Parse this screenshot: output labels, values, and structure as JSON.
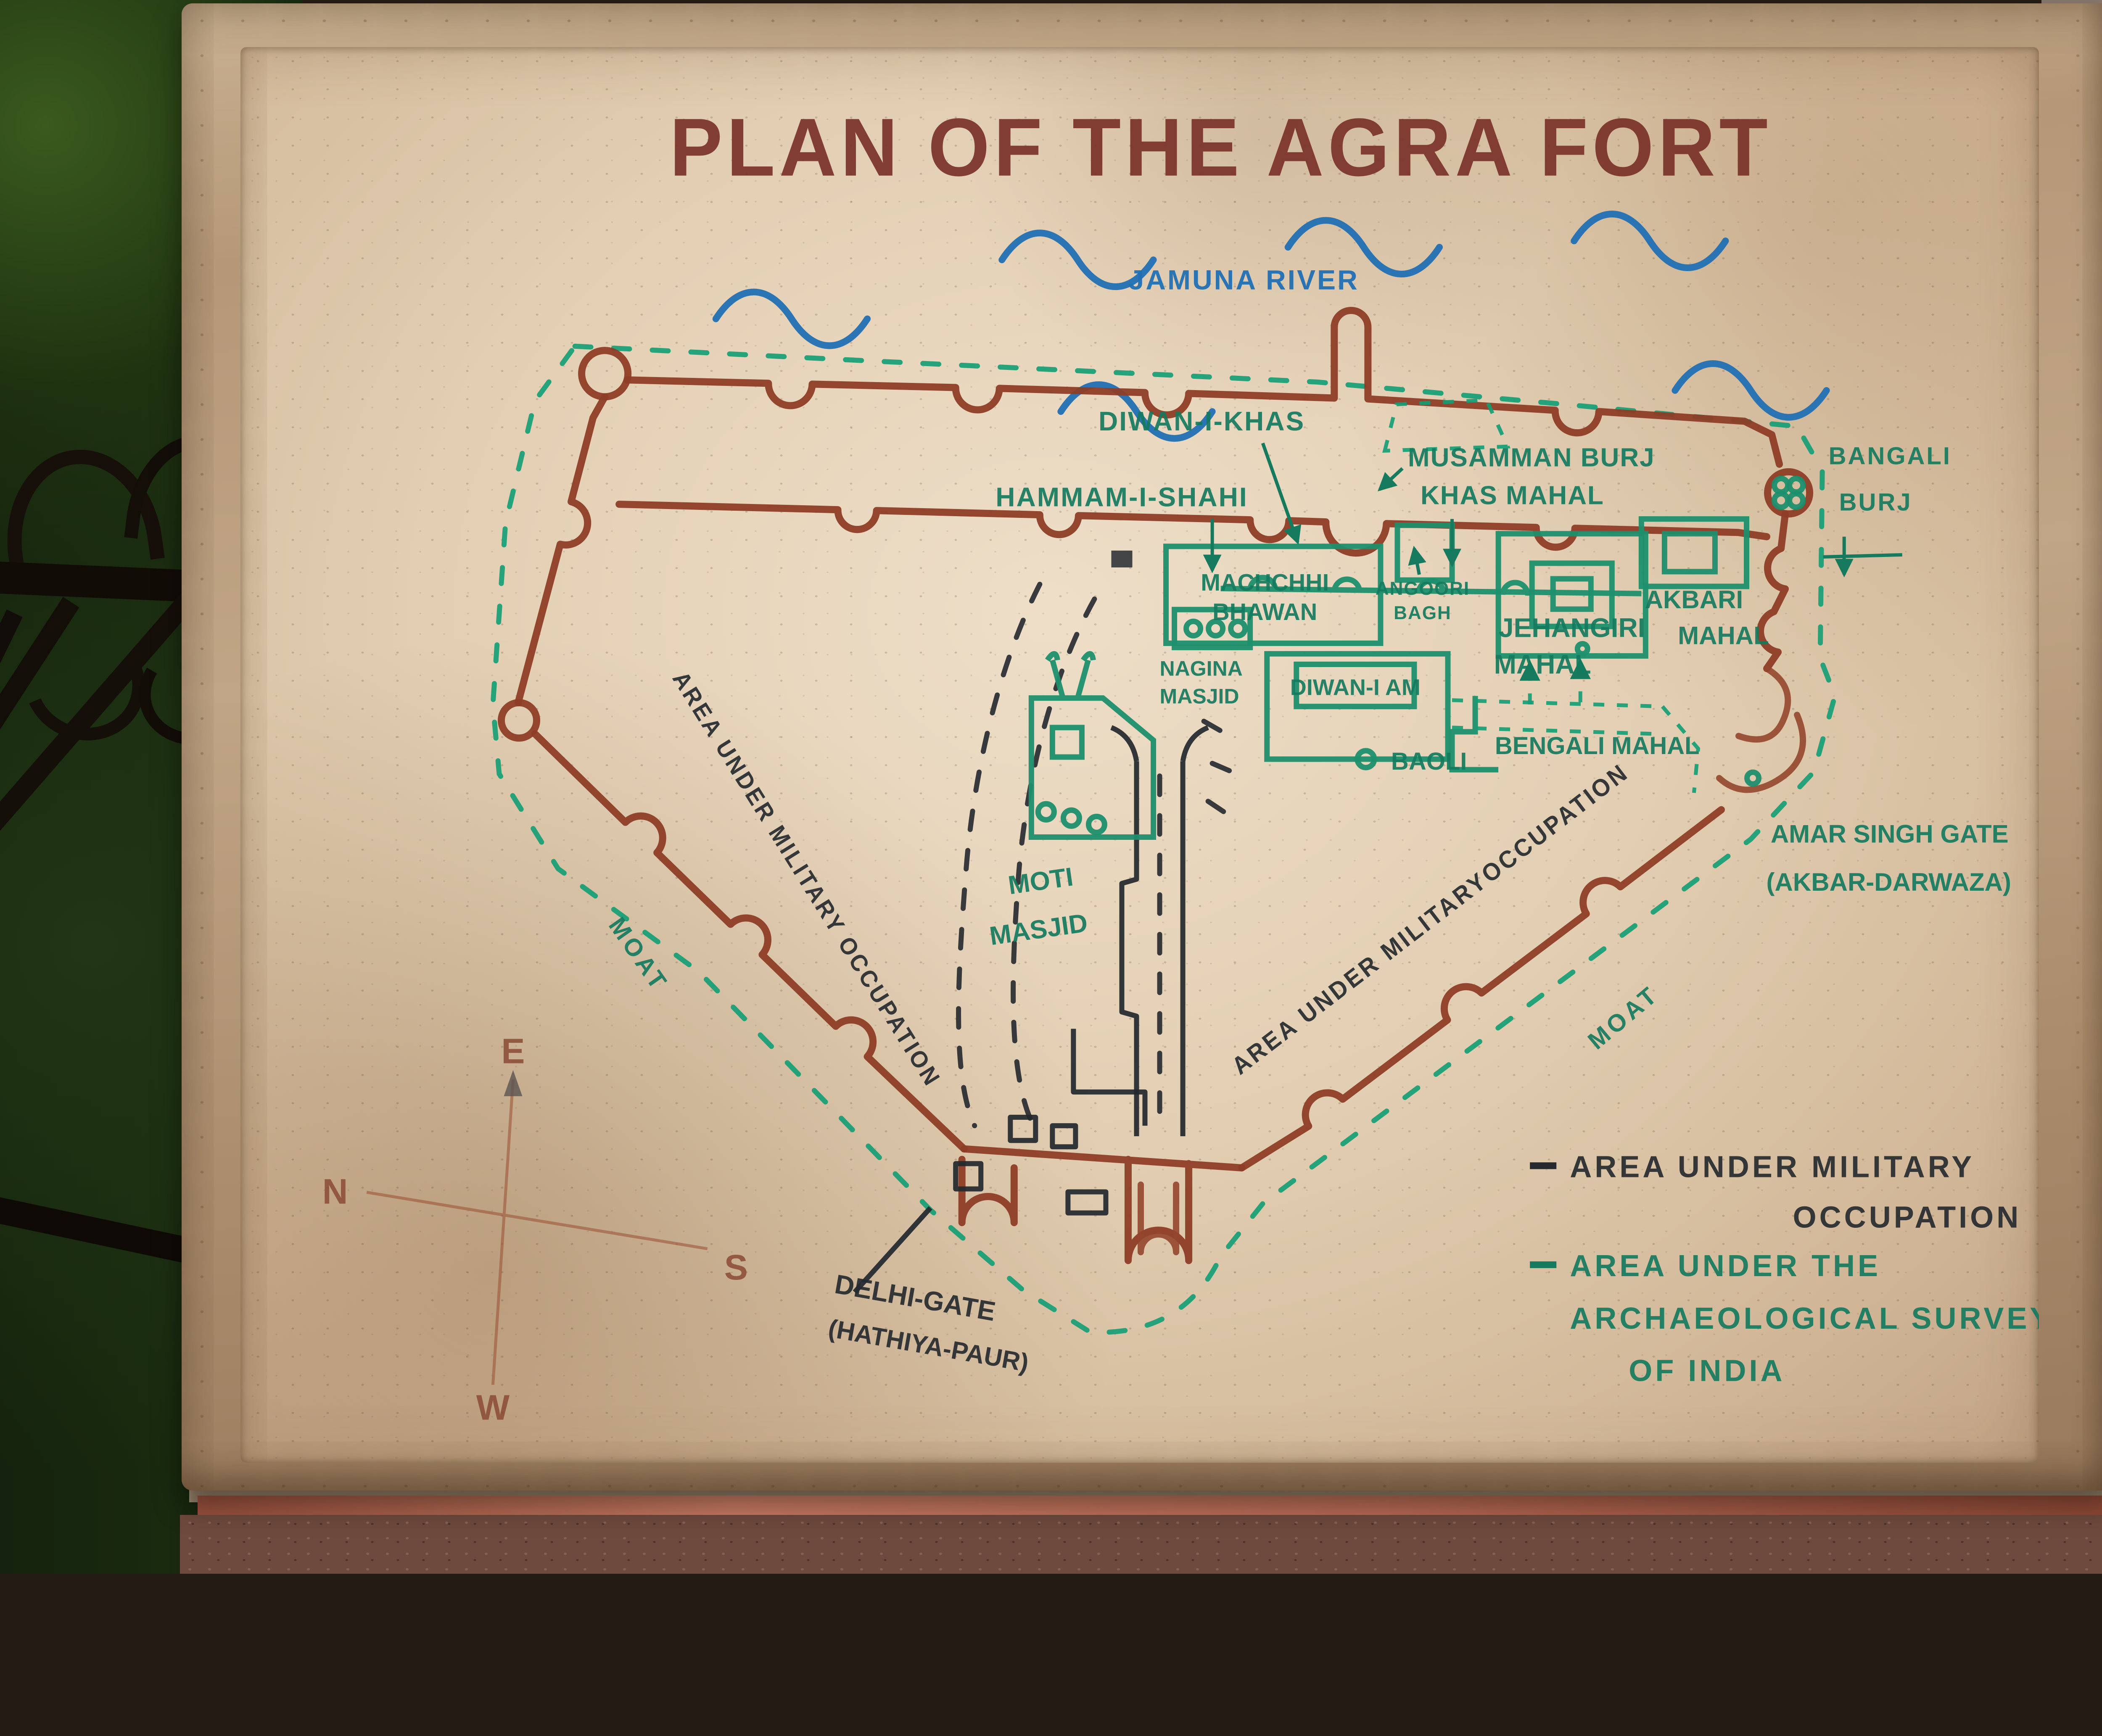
{
  "title": {
    "text": "PLAN OF THE AGRA FORT",
    "color": "#7b332a"
  },
  "river": {
    "label": "JAMUNA RIVER",
    "color": "#2170b4"
  },
  "places": {
    "diwan_i_khas": "DIWAN-I-KHAS",
    "hammam_i_shahi": "HAMMAM-I-SHAHI",
    "musamman_burj": "MUSAMMAN BURJ",
    "khas_mahal": "KHAS MAHAL",
    "bangali_line1": "BANGALI",
    "bangali_line2": "BURJ",
    "machchhi_line1": "MACHCHHI",
    "machchhi_line2": "BHAWAN",
    "angoori_line1": "ANGOORI",
    "angoori_line2": "BAGH",
    "nagina_line1": "NAGINA",
    "nagina_line2": "MASJID",
    "diwan_i_am": "DIWAN-I AM",
    "jehangiri_line1": "JEHANGIRI",
    "jehangiri_line2": "MAHAL",
    "akbari_line1": "AKBARI",
    "akbari_line2": "MAHAL",
    "baoli": "BAOLI",
    "bengali_mahal": "BENGALI MAHAL",
    "moti_line1": "MOTI",
    "moti_line2": "MASJID",
    "amar_line1": "AMAR SINGH GATE",
    "amar_line2": "(AKBAR-DARWAZA)",
    "delhi_line1": "DELHI-GATE",
    "delhi_line2": "(HATHIYA-PAUR)",
    "area_military_left": "AREA UNDER MILITARY OCCUPATION",
    "area_military_right": "AREA UNDER MILITARYOCCUPATION",
    "moat_left": "MOAT",
    "moat_right": "MOAT"
  },
  "compass": {
    "east": "E",
    "north": "N",
    "south": "S",
    "west": "W"
  },
  "legend": {
    "military_line1": "AREA UNDER MILITARY",
    "military_line2": "OCCUPATION",
    "military_color": "#262a2f",
    "asi_line1": "AREA UNDER THE",
    "asi_line2": "ARCHAEOLOGICAL SURVEY",
    "asi_line3": "OF INDIA",
    "asi_color": "#157a5e"
  },
  "map_colors": {
    "fort_wall": "#8e3d26",
    "asi_boundary": "#129d74",
    "buildings": "#1d8f6d",
    "military_marks": "#23282e",
    "river_waves": "#2170b4",
    "marble": "#e2ceb2",
    "stone_frame": "#b59878"
  }
}
